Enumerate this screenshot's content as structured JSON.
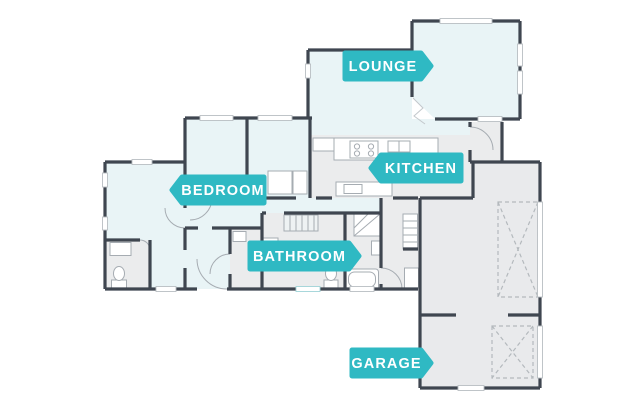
{
  "colors": {
    "accent": "#2FB9C3",
    "label_text": "#FFFFFF",
    "wall": "#3F4650",
    "room": "#E9F4F6",
    "floor": "#EBECED",
    "garage_floor": "#E9EAEC",
    "fixture_line": "#A6ACB2",
    "dash_line": "#B4B9BD",
    "background": "#FFFFFF"
  },
  "labels": {
    "lounge": {
      "text": "LOUNGE",
      "arrow": "right"
    },
    "kitchen": {
      "text": "KITCHEN",
      "arrow": "left"
    },
    "bedroom": {
      "text": "BEDROOM",
      "arrow": "left"
    },
    "bathroom": {
      "text": "BATHROOM",
      "arrow": "right"
    },
    "garage": {
      "text": "GARAGE",
      "arrow": "right"
    }
  },
  "rooms": [
    "Lounge",
    "Kitchen",
    "Bedroom",
    "Bathroom",
    "Garage"
  ]
}
